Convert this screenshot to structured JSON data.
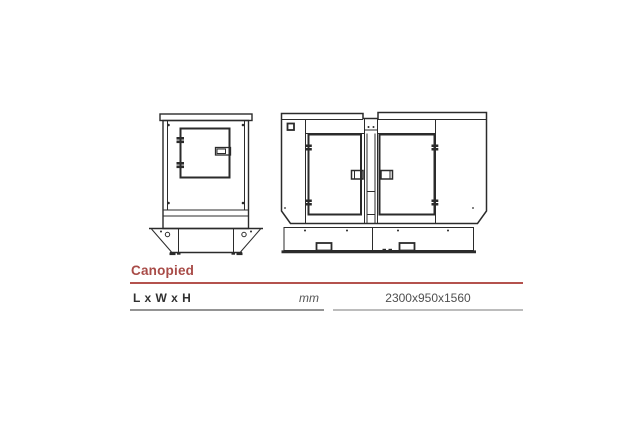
{
  "colors": {
    "accent-red": "#a84b47",
    "rule-red": "#b4524e",
    "text-dark": "#303030",
    "text-gray": "#4f4f4f",
    "unit-gray": "#555555",
    "line-ink": "#2b2b2b",
    "rule-gray-left": "#949494",
    "rule-gray-right": "#bcbcbc"
  },
  "section": {
    "heading": "Canopied"
  },
  "spec_table": {
    "rows": [
      {
        "label": "L x W x H",
        "unit": "mm",
        "value": "2300x950x1560"
      }
    ]
  }
}
